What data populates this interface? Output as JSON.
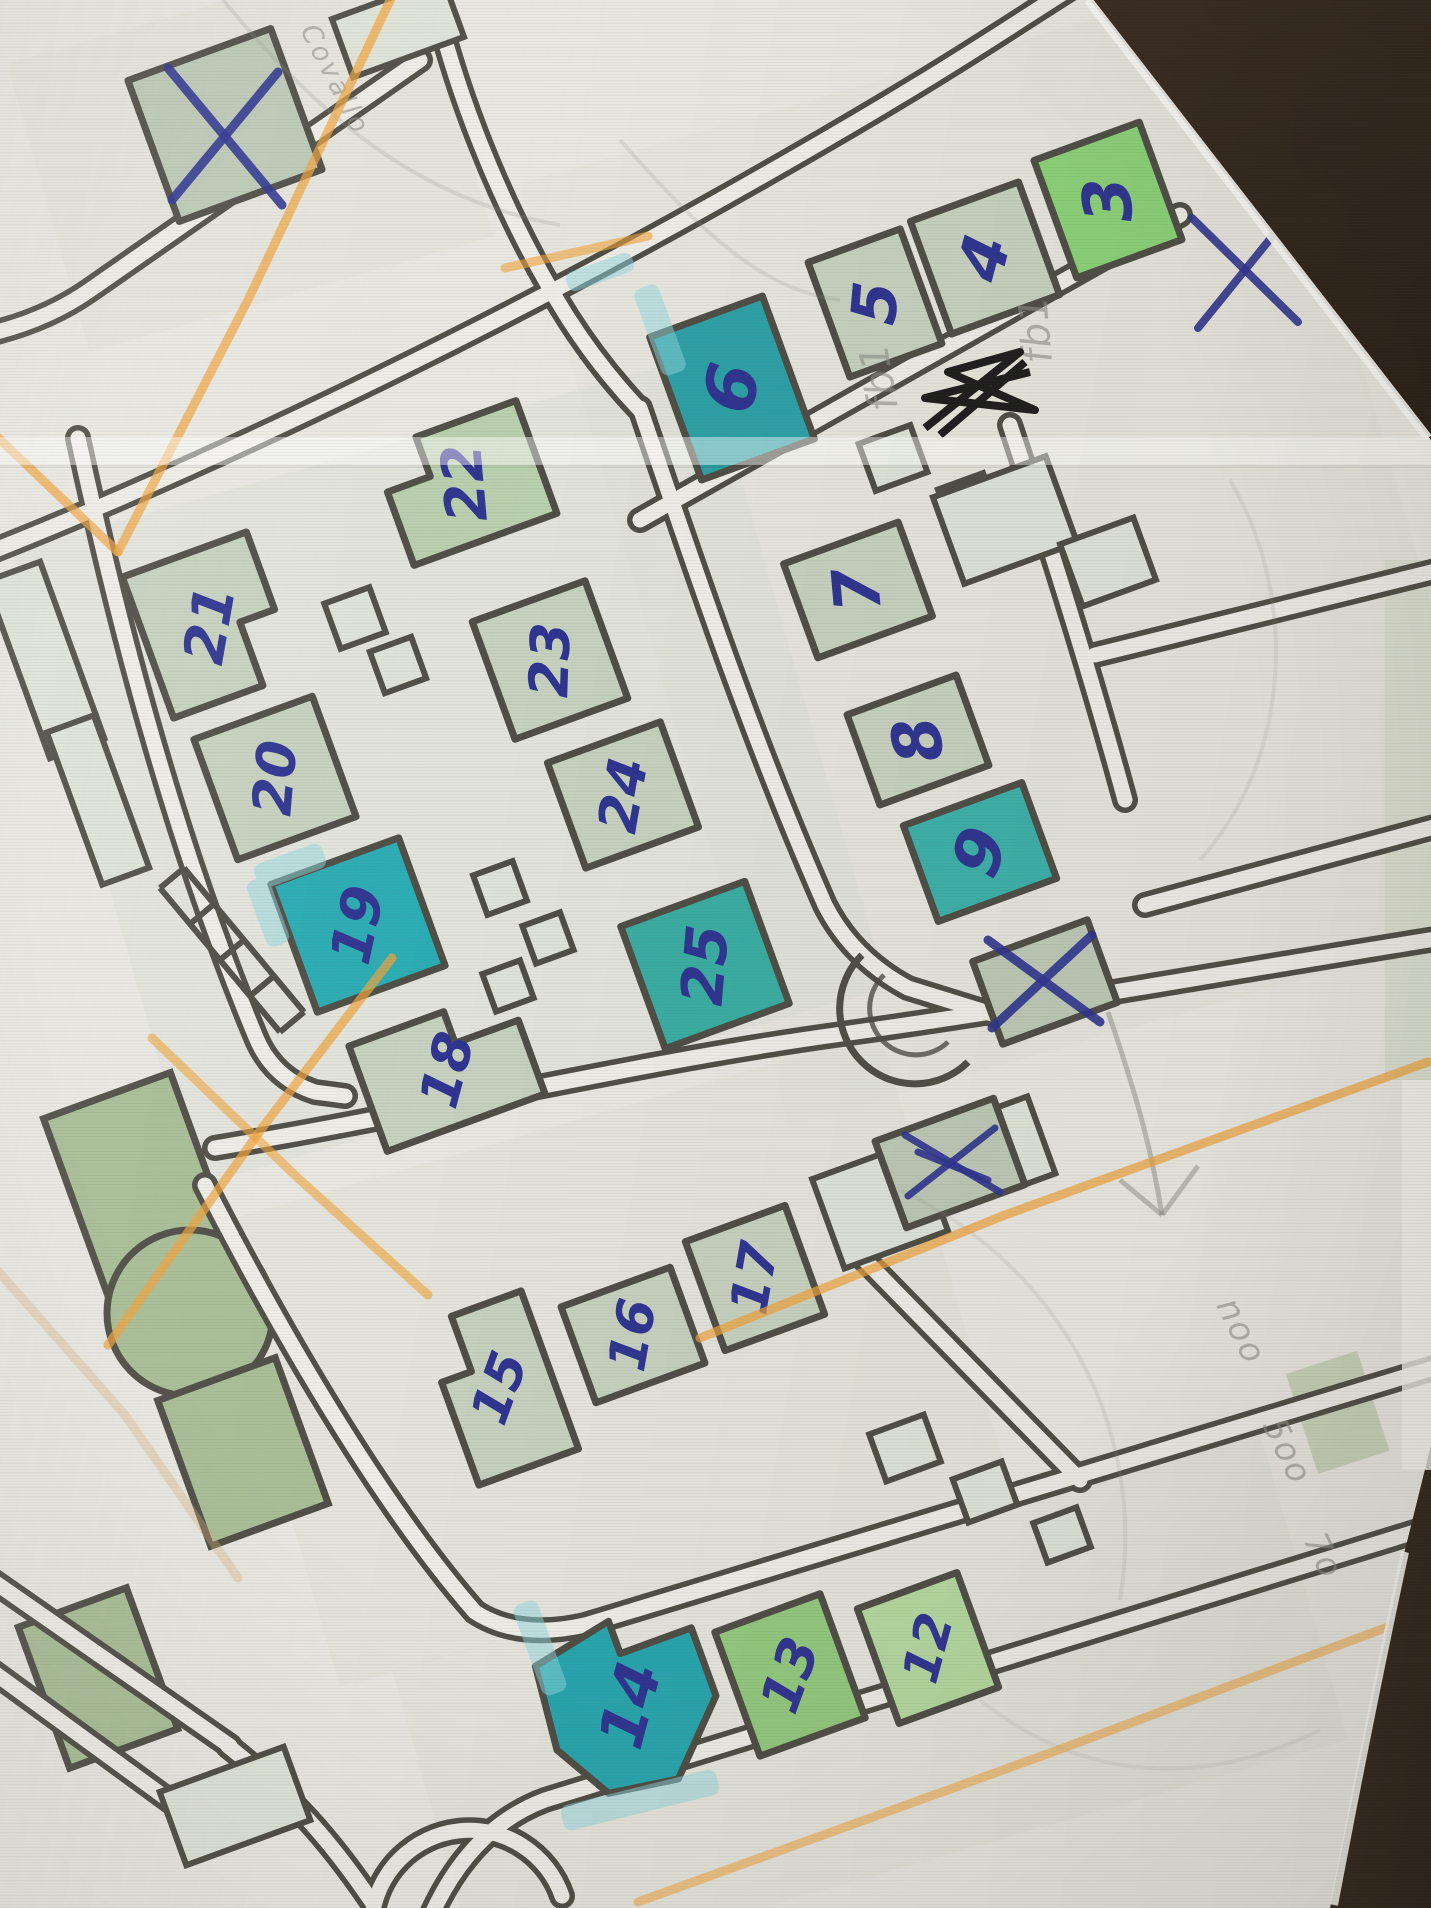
{
  "scene": {
    "kind": "photograph of a hand-annotated printed street map on a dark table",
    "paper_color": "#e8e7e1",
    "road_inner_color": "#edece6",
    "line_color": "#4e4e46",
    "ink_color": "#2f3490",
    "pencil_color": "#8b8e85",
    "orange_color": "#f0a33a",
    "table_dark": "#271e16",
    "table_light": "#3a2d23"
  },
  "fills": {
    "pale": "#c6d1bf",
    "pale2": "#b9cfae",
    "white": "#e3e5dc",
    "bright": "#8bd178",
    "teal6": "#2da0a6",
    "teal9": "#3cb0a9",
    "teal19": "#2bacb4",
    "teal25": "#3aada2",
    "teal14": "#28a5ad",
    "green12": "#b5d8a0",
    "green13": "#93c87e",
    "xfill": "#bcc9b6",
    "park": "#a8bd96",
    "small": "#dfe3d7"
  },
  "buildings": [
    {
      "label": "3",
      "cx": 1108,
      "cy": 200,
      "w": 112,
      "h": 125,
      "rot": -20,
      "fill": "bright",
      "trot": -95,
      "fs": 66
    },
    {
      "label": "4",
      "cx": 985,
      "cy": 258,
      "w": 115,
      "h": 120,
      "rot": -20,
      "fill": "pale",
      "trot": -75,
      "fs": 64
    },
    {
      "label": "5",
      "cx": 875,
      "cy": 303,
      "w": 98,
      "h": 122,
      "rot": -20,
      "fill": "pale",
      "trot": -85,
      "fs": 62
    },
    {
      "label": "6",
      "cx": 732,
      "cy": 388,
      "w": 120,
      "h": 152,
      "rot": -20,
      "fill": "teal6",
      "trot": -80,
      "fs": 70
    },
    {
      "label": "7",
      "cx": 858,
      "cy": 590,
      "w": 122,
      "h": 100,
      "rot": -20,
      "fill": "pale",
      "trot": -95,
      "fs": 64
    },
    {
      "label": "8",
      "cx": 918,
      "cy": 740,
      "w": 116,
      "h": 96,
      "rot": -20,
      "fill": "pale",
      "trot": -100,
      "fs": 66
    },
    {
      "label": "9",
      "cx": 980,
      "cy": 852,
      "w": 126,
      "h": 102,
      "rot": -20,
      "fill": "teal9",
      "trot": -70,
      "fs": 66
    },
    {
      "label": "22",
      "cx": 465,
      "cy": 483,
      "w": 152,
      "h": 120,
      "rot": -20,
      "fill": "pale2",
      "trot": -95,
      "fs": 56,
      "poly": [
        [
          0,
          0.35
        ],
        [
          0.3,
          0.35
        ],
        [
          0.3,
          0
        ],
        [
          1,
          0
        ],
        [
          1,
          1
        ],
        [
          0,
          1
        ]
      ]
    },
    {
      "label": "21",
      "cx": 210,
      "cy": 625,
      "w": 132,
      "h": 150,
      "rot": -20,
      "fill": "pale",
      "trot": -80,
      "fs": 56,
      "poly": [
        [
          0,
          0
        ],
        [
          1,
          0
        ],
        [
          1,
          0.55
        ],
        [
          0.72,
          0.55
        ],
        [
          0.72,
          1
        ],
        [
          0,
          1
        ]
      ]
    },
    {
      "label": "23",
      "cx": 550,
      "cy": 660,
      "w": 120,
      "h": 125,
      "rot": -20,
      "fill": "pale",
      "trot": -88,
      "fs": 54
    },
    {
      "label": "20",
      "cx": 275,
      "cy": 778,
      "w": 126,
      "h": 128,
      "rot": -20,
      "fill": "pale",
      "trot": -85,
      "fs": 54
    },
    {
      "label": "24",
      "cx": 623,
      "cy": 795,
      "w": 120,
      "h": 112,
      "rot": -20,
      "fill": "pale",
      "trot": -80,
      "fs": 54
    },
    {
      "label": "19",
      "cx": 358,
      "cy": 925,
      "w": 136,
      "h": 136,
      "rot": -20,
      "fill": "teal19",
      "trot": -78,
      "fs": 56
    },
    {
      "label": "25",
      "cx": 705,
      "cy": 965,
      "w": 132,
      "h": 130,
      "rot": -20,
      "fill": "teal25",
      "trot": -85,
      "fs": 58
    },
    {
      "label": "18",
      "cx": 447,
      "cy": 1070,
      "w": 168,
      "h": 112,
      "rot": -20,
      "fill": "pale",
      "trot": -75,
      "fs": 54,
      "poly": [
        [
          0,
          0
        ],
        [
          0.6,
          0
        ],
        [
          0.6,
          0.3
        ],
        [
          1,
          0.3
        ],
        [
          1,
          1
        ],
        [
          0,
          1
        ]
      ]
    },
    {
      "label": "17",
      "cx": 755,
      "cy": 1278,
      "w": 106,
      "h": 116,
      "rot": -20,
      "fill": "pale",
      "trot": -80,
      "fs": 52
    },
    {
      "label": "16",
      "cx": 633,
      "cy": 1335,
      "w": 116,
      "h": 102,
      "rot": -20,
      "fill": "pale",
      "trot": -80,
      "fs": 52
    },
    {
      "label": "15",
      "cx": 500,
      "cy": 1388,
      "w": 106,
      "h": 168,
      "rot": -20,
      "fill": "pale",
      "trot": -70,
      "fs": 52,
      "poly": [
        [
          0.3,
          0
        ],
        [
          1,
          0
        ],
        [
          1,
          1
        ],
        [
          0,
          1
        ],
        [
          0,
          0.35
        ],
        [
          0.3,
          0.35
        ]
      ]
    },
    {
      "label": "14",
      "cx": 630,
      "cy": 1705,
      "w": 168,
      "h": 172,
      "rot": -20,
      "fill": "teal14",
      "trot": -75,
      "fs": 62,
      "poly": [
        [
          0.05,
          0.1
        ],
        [
          0.55,
          0
        ],
        [
          0.55,
          0.2
        ],
        [
          1,
          0.2
        ],
        [
          1,
          0.62
        ],
        [
          0.62,
          1
        ],
        [
          0.2,
          0.94
        ],
        [
          0,
          0.6
        ]
      ]
    },
    {
      "label": "13",
      "cx": 790,
      "cy": 1675,
      "w": 112,
      "h": 132,
      "rot": -20,
      "fill": "green13",
      "trot": -70,
      "fs": 54
    },
    {
      "label": "12",
      "cx": 928,
      "cy": 1648,
      "w": 106,
      "h": 122,
      "rot": -20,
      "fill": "green12",
      "trot": -75,
      "fs": 50
    },
    {
      "label": "",
      "cx": 225,
      "cy": 125,
      "w": 152,
      "h": 150,
      "rot": -20,
      "fill": "xfill",
      "name": "crossed-building-top-left"
    },
    {
      "label": "",
      "cx": 1045,
      "cy": 982,
      "w": 122,
      "h": 88,
      "rot": -20,
      "fill": "xfill",
      "name": "crossed-building-right"
    },
    {
      "label": "",
      "cx": 950,
      "cy": 1163,
      "w": 126,
      "h": 92,
      "rot": -20,
      "fill": "xfill",
      "name": "crossed-building-small"
    }
  ],
  "small_structures": [
    {
      "cx": 355,
      "cy": 618,
      "w": 48,
      "h": 48
    },
    {
      "cx": 398,
      "cy": 665,
      "w": 44,
      "h": 44
    },
    {
      "cx": 500,
      "cy": 888,
      "w": 42,
      "h": 42
    },
    {
      "cx": 548,
      "cy": 938,
      "w": 40,
      "h": 40
    },
    {
      "cx": 508,
      "cy": 986,
      "w": 40,
      "h": 40
    },
    {
      "cx": 893,
      "cy": 458,
      "w": 55,
      "h": 50
    },
    {
      "cx": 968,
      "cy": 502,
      "w": 48,
      "h": 44
    },
    {
      "cx": 905,
      "cy": 1448,
      "w": 58,
      "h": 50
    },
    {
      "cx": 985,
      "cy": 1492,
      "w": 52,
      "h": 46
    },
    {
      "cx": 1062,
      "cy": 1535,
      "w": 46,
      "h": 42
    },
    {
      "cx": 880,
      "cy": 1205,
      "w": 110,
      "h": 95
    },
    {
      "cx": 1000,
      "cy": 1150,
      "w": 88,
      "h": 82
    },
    {
      "cx": 398,
      "cy": 28,
      "w": 118,
      "h": 62
    },
    {
      "cx": 45,
      "cy": 660,
      "w": 58,
      "h": 188
    },
    {
      "cx": 98,
      "cy": 800,
      "w": 50,
      "h": 162
    },
    {
      "cx": 235,
      "cy": 1806,
      "w": 132,
      "h": 78
    },
    {
      "cx": 1005,
      "cy": 520,
      "w": 120,
      "h": 92
    },
    {
      "cx": 1108,
      "cy": 562,
      "w": 78,
      "h": 66
    }
  ],
  "park_shapes": [
    {
      "type": "rect",
      "cx": 142,
      "cy": 1192,
      "w": 135,
      "h": 205,
      "rot": -20
    },
    {
      "type": "circle",
      "cx": 190,
      "cy": 1313,
      "r": 83
    },
    {
      "type": "rect",
      "cx": 243,
      "cy": 1452,
      "w": 125,
      "h": 155,
      "rot": -20
    },
    {
      "type": "rect",
      "cx": 98,
      "cy": 1678,
      "w": 115,
      "h": 150,
      "rot": -20
    }
  ],
  "marker_streaks": [
    {
      "cx": 660,
      "cy": 330,
      "w": 26,
      "h": 92,
      "rot": -20
    },
    {
      "cx": 600,
      "cy": 272,
      "w": 70,
      "h": 20,
      "rot": -20
    },
    {
      "cx": 290,
      "cy": 866,
      "w": 72,
      "h": 26,
      "rot": -20
    },
    {
      "cx": 268,
      "cy": 912,
      "w": 24,
      "h": 70,
      "rot": -20
    },
    {
      "cx": 540,
      "cy": 1648,
      "w": 26,
      "h": 96,
      "rot": -20
    },
    {
      "cx": 640,
      "cy": 1800,
      "w": 160,
      "h": 26,
      "rot": -14
    }
  ],
  "x_marks": [
    {
      "name": "x-on-top-left-building",
      "lines": [
        [
          168,
          68,
          282,
          205
        ],
        [
          278,
          72,
          172,
          200
        ]
      ],
      "w": 9
    },
    {
      "name": "x-on-right-building",
      "lines": [
        [
          988,
          940,
          1100,
          1022
        ],
        [
          1092,
          935,
          992,
          1028
        ]
      ],
      "w": 9
    },
    {
      "name": "x-on-small-square",
      "lines": [
        [
          905,
          1135,
          1000,
          1192
        ],
        [
          995,
          1128,
          908,
          1196
        ],
        [
          918,
          1152,
          988,
          1180
        ]
      ],
      "w": 7
    },
    {
      "name": "blue-x-near-paper-edge",
      "lines": [
        [
          1192,
          218,
          1298,
          322
        ],
        [
          1292,
          212,
          1198,
          328
        ]
      ],
      "w": 8
    }
  ],
  "black_scribble": {
    "paths": [
      "M 925 428 L 1020 352 L 948 372 L 1035 410 L 925 398 L 1030 372",
      "M 940 435 L 1025 362"
    ]
  },
  "pencil_notes": [
    {
      "text": "Covallo",
      "x": 300,
      "y": 30,
      "rot": 63,
      "size": 27,
      "spacing": 3
    },
    {
      "text": "fb1",
      "x": 1052,
      "y": 362,
      "rot": -95,
      "size": 40,
      "spacing": 1
    },
    {
      "text": "fb1",
      "x": 898,
      "y": 408,
      "rot": -100,
      "size": 40,
      "spacing": 1
    },
    {
      "text": "noo",
      "x": 1216,
      "y": 1305,
      "rot": 64,
      "size": 34,
      "spacing": 2
    },
    {
      "text": "5oo",
      "x": 1262,
      "y": 1425,
      "rot": 64,
      "size": 34,
      "spacing": 2
    },
    {
      "text": "7o",
      "x": 1303,
      "y": 1540,
      "rot": 64,
      "size": 34,
      "spacing": 2
    }
  ],
  "pencil_arrow": {
    "shaft": "M 1108 1012 C 1132 1082 1150 1140 1162 1215",
    "head": [
      [
        1162,
        1215,
        1120,
        1180
      ],
      [
        1162,
        1215,
        1198,
        1166
      ]
    ]
  },
  "pencil_curves": [
    "M 215 -10 C 320 120 420 200 560 225",
    "M 1230 480 C 1300 600 1290 760 1200 860",
    "M 900 1190 C 1050 1260 1150 1420 1120 1600",
    "M 980 1700 C 1080 1780 1200 1790 1320 1730",
    "M 620 140 C 700 230 760 290 840 300"
  ],
  "orange_routes": [
    {
      "pts": [
        [
          395,
          -10
        ],
        [
          248,
          300
        ],
        [
          118,
          552
        ]
      ],
      "o": 0.7
    },
    {
      "pts": [
        [
          -10,
          430
        ],
        [
          118,
          552
        ]
      ],
      "o": 0.7
    },
    {
      "pts": [
        [
          505,
          268
        ],
        [
          648,
          236
        ]
      ],
      "o": 0.6
    },
    {
      "pts": [
        [
          392,
          958
        ],
        [
          262,
          1128
        ],
        [
          108,
          1345
        ]
      ],
      "o": 0.7
    },
    {
      "pts": [
        [
          152,
          1038
        ],
        [
          300,
          1180
        ],
        [
          428,
          1295
        ]
      ],
      "o": 0.6
    },
    {
      "pts": [
        [
          700,
          1338
        ],
        [
          1005,
          1215
        ],
        [
          1428,
          1062
        ]
      ],
      "o": 0.7
    },
    {
      "pts": [
        [
          638,
          1902
        ],
        [
          1050,
          1753
        ],
        [
          1428,
          1612
        ]
      ],
      "o": 0.55
    },
    {
      "pts": [
        [
          -10,
          1262
        ],
        [
          125,
          1415
        ],
        [
          238,
          1578
        ]
      ],
      "o": 0.35,
      "color": "#d8b07a"
    }
  ],
  "creases": [
    {
      "y": 437,
      "h": 28
    }
  ],
  "table_corners": {
    "top_right": "M 1090 0 L 1431 0 L 1431 440 Z",
    "top_right_edge": "M 1088 0 L 1428 438",
    "bottom_right": "M 1431 1445 L 1431 1908 L 1330 1908 Q 1372 1700 1403 1558 Z",
    "bottom_right_edge": "M 1405 1552 Q 1372 1705 1334 1905"
  }
}
